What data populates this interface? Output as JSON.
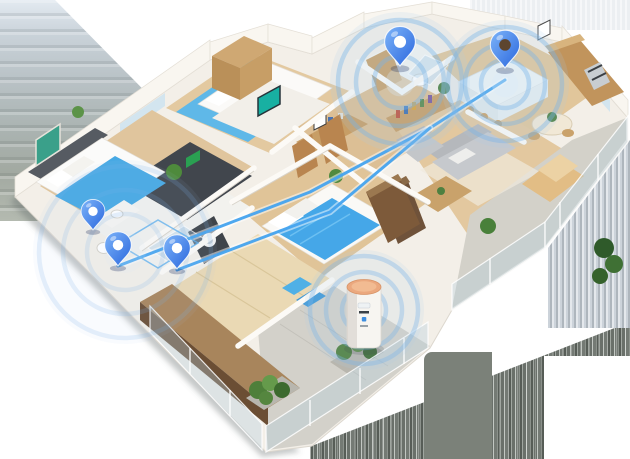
{
  "canvas": {
    "width": 630,
    "height": 459
  },
  "palette": {
    "pin_top": "#6fa9f7",
    "pin_bottom": "#2e6fe0",
    "wave_ring": "#79b4e8",
    "wave_fill": "#a9cdec",
    "wave_glow": "#d8ecfb",
    "connection_line": "#45a3ee",
    "device_body": "#f7f5f1",
    "device_top": "#eba87e"
  },
  "pins": [
    {
      "name": "pin-left-bathroom",
      "x": 93,
      "y": 230,
      "scale": 0.85,
      "hole": "#ffffff"
    },
    {
      "name": "pin-left-hall",
      "x": 118,
      "y": 266,
      "scale": 0.95,
      "hole": "#ffffff"
    },
    {
      "name": "pin-laundry-closet",
      "x": 177,
      "y": 269,
      "scale": 0.95,
      "hole": "#ffffff"
    },
    {
      "name": "pin-top-bathroom",
      "x": 400,
      "y": 66,
      "scale": 1.1,
      "hole": "#ffffff"
    },
    {
      "name": "pin-kitchen",
      "x": 505,
      "y": 68,
      "scale": 1.05,
      "hole": "#5d452f"
    }
  ],
  "waves": [
    {
      "name": "wave-top-bathroom",
      "cx": 400,
      "cy": 82,
      "radii": [
        26,
        44,
        62
      ],
      "disc": 70,
      "opacity": 1.0
    },
    {
      "name": "wave-kitchen",
      "cx": 505,
      "cy": 84,
      "radii": [
        24,
        40,
        57
      ],
      "disc": 64,
      "opacity": 1.0
    },
    {
      "name": "wave-device",
      "cx": 364,
      "cy": 310,
      "radii": [
        22,
        38,
        54
      ],
      "disc": 60,
      "opacity": 0.9
    },
    {
      "name": "wave-left-cluster",
      "cx": 125,
      "cy": 252,
      "radii": [
        38,
        62,
        86
      ],
      "disc": 92,
      "opacity": 0.45
    }
  ],
  "connections": [
    {
      "name": "connection-line-upper",
      "points": "118,266 310,192 430,128 505,80"
    },
    {
      "name": "connection-line-lower",
      "points": "177,270 330,212 430,128"
    }
  ],
  "routing_outline": {
    "name": "floor-routing-outline",
    "points": "118,244 158,220 198,243 158,268"
  },
  "device": {
    "name": "smart-hub-device",
    "x": 364,
    "y": 315
  }
}
